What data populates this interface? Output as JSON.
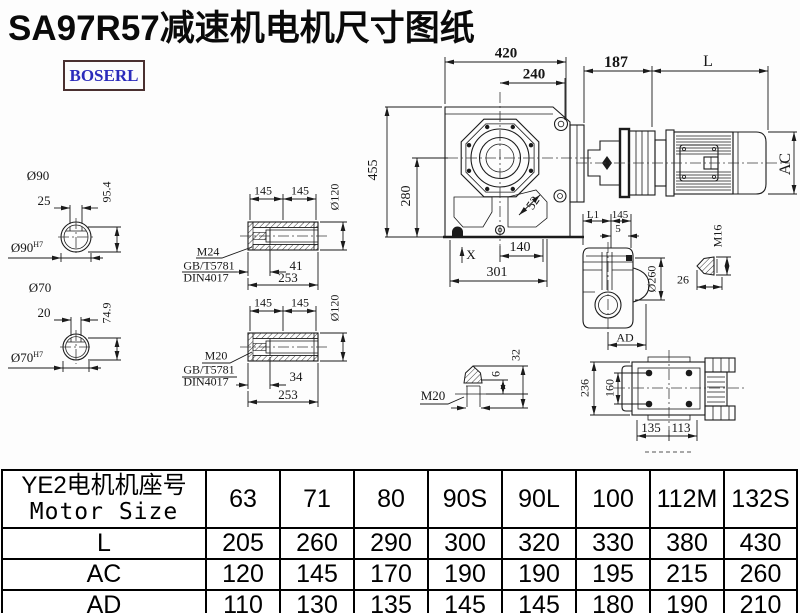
{
  "page": {
    "title": "SA97R57减速机电机尺寸图纸",
    "brand": "BOSERL"
  },
  "dims": {
    "front_width": "420",
    "front_inner_width": "240",
    "motor_flange_len": "187",
    "motor_len": "L",
    "motor_ac": "AC",
    "front_height": "455",
    "front_inner_height": "280",
    "corner_dim": "52",
    "foot_len": "140",
    "base_len": "301",
    "x_mark": "X",
    "shaft90_dia": "Ø90",
    "shaft90_key": "25",
    "shaft90_height": "95.4",
    "shaft90_bore": "Ø90",
    "shaft90_fit": "H7",
    "shaft70_dia": "Ø70",
    "shaft70_key": "20",
    "shaft70_height": "74.9",
    "shaft70_bore": "Ø70",
    "shaft70_fit": "H7",
    "hollow1": {
      "len_a": "145",
      "len_b": "145",
      "dia": "Ø120",
      "thread": "M24",
      "std1": "GB/T5781",
      "std2": "DIN4017",
      "depth": "41",
      "total": "253"
    },
    "hollow2": {
      "len_a": "145",
      "len_b": "145",
      "dia": "Ø120",
      "thread": "M20",
      "std1": "GB/T5781",
      "std2": "DIN4017",
      "depth": "34",
      "total": "253"
    },
    "side": {
      "l1": "L1",
      "len": "145",
      "gap": "5",
      "dia": "Ø260",
      "ad": "AD"
    },
    "bolt16": {
      "thread": "M16",
      "len": "26"
    },
    "bolt20": {
      "thread": "M20",
      "d1": "6",
      "d2": "32"
    },
    "top_view": {
      "height": "236",
      "hole_span": "160",
      "w1": "135",
      "w2": "113"
    }
  },
  "table": {
    "header_cn": "YE2电机机座号",
    "header_en": "Motor Size",
    "columns": [
      "63",
      "71",
      "80",
      "90S",
      "90L",
      "100",
      "112M",
      "132S"
    ],
    "rows": [
      {
        "label": "L",
        "values": [
          "205",
          "260",
          "290",
          "300",
          "320",
          "330",
          "380",
          "430"
        ]
      },
      {
        "label": "AC",
        "values": [
          "120",
          "145",
          "170",
          "190",
          "190",
          "195",
          "215",
          "260"
        ]
      },
      {
        "label": "AD",
        "values": [
          "110",
          "130",
          "135",
          "145",
          "145",
          "180",
          "190",
          "210"
        ]
      }
    ]
  }
}
